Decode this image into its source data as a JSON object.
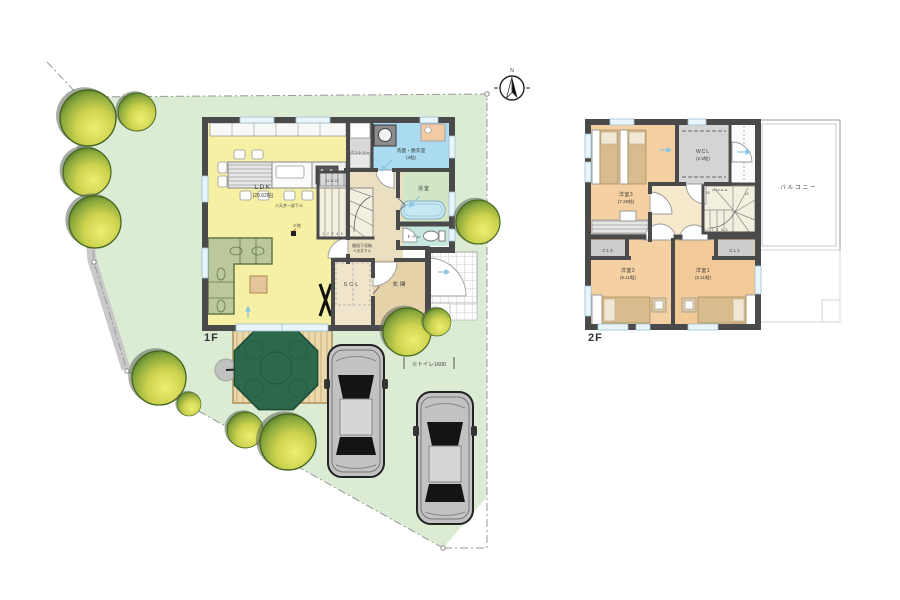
{
  "palette": {
    "site_green": "#dbebd4",
    "wall_gray": "#4a4a4a",
    "ldk_yellow": "#f5f0a4",
    "washroom_blue": "#abdbf0",
    "bath_green": "#d2e5c4",
    "toilet_teal": "#c6e7df",
    "hall_tan": "#ebdfc2",
    "entry_tan": "#e6d2a9",
    "bedroom_peach": "#f5d0a2",
    "closet_gray": "#cccccc",
    "wcl_gray": "#d4d4d4",
    "tree_dark_green": "#2f5a22",
    "tree_yellow": "#eeee72",
    "parasol_green": "#2e684a",
    "car_gray": "#c2c2c2",
    "note_orange": "#e06818"
  },
  "compass": {
    "north_label": "N"
  },
  "site": {
    "dimension_note": "※トイレ1600"
  },
  "floor1": {
    "label": "1F",
    "rooms": {
      "ldk": {
        "name": "LDK",
        "size": "(20.62帖)"
      },
      "pantry": {
        "name": "パントリー"
      },
      "washroom": {
        "name": "洗面・脱衣室",
        "size": "(3帖)"
      },
      "bath": {
        "name": "浴室"
      },
      "toilet": {
        "name": "トイレ"
      },
      "scl": {
        "name": "SCL"
      },
      "entrance": {
        "name": "玄関"
      }
    },
    "notes": {
      "ceiling": "※天井一部下ル",
      "pillar": "※柱",
      "stair_storage": "階段下収納",
      "stair_ceiling": "※天井下ル"
    },
    "stairs": {
      "lower_numbers": "1 2 3 4 5",
      "upper_numbers": "11 12 13"
    }
  },
  "floor2": {
    "label": "2F",
    "rooms": {
      "bedroom3": {
        "name": "洋室3",
        "size": "(7.25帖)"
      },
      "wcl": {
        "name": "WCL",
        "size": "(2.5帖)"
      },
      "balcony": {
        "name": "バルコニー"
      },
      "closet2": {
        "name": "CL2"
      },
      "closet1": {
        "name": "CL1"
      },
      "bedroom2": {
        "name": "洋室2",
        "size": "(5.11帖)"
      },
      "bedroom1": {
        "name": "洋室1",
        "size": "(5.11帖)"
      }
    },
    "stairs": {
      "top_left_number": "15",
      "top_numbers": "14 13 12 11",
      "top_right_number": "10",
      "lower_numbers": "1 2 3 4 5"
    }
  }
}
